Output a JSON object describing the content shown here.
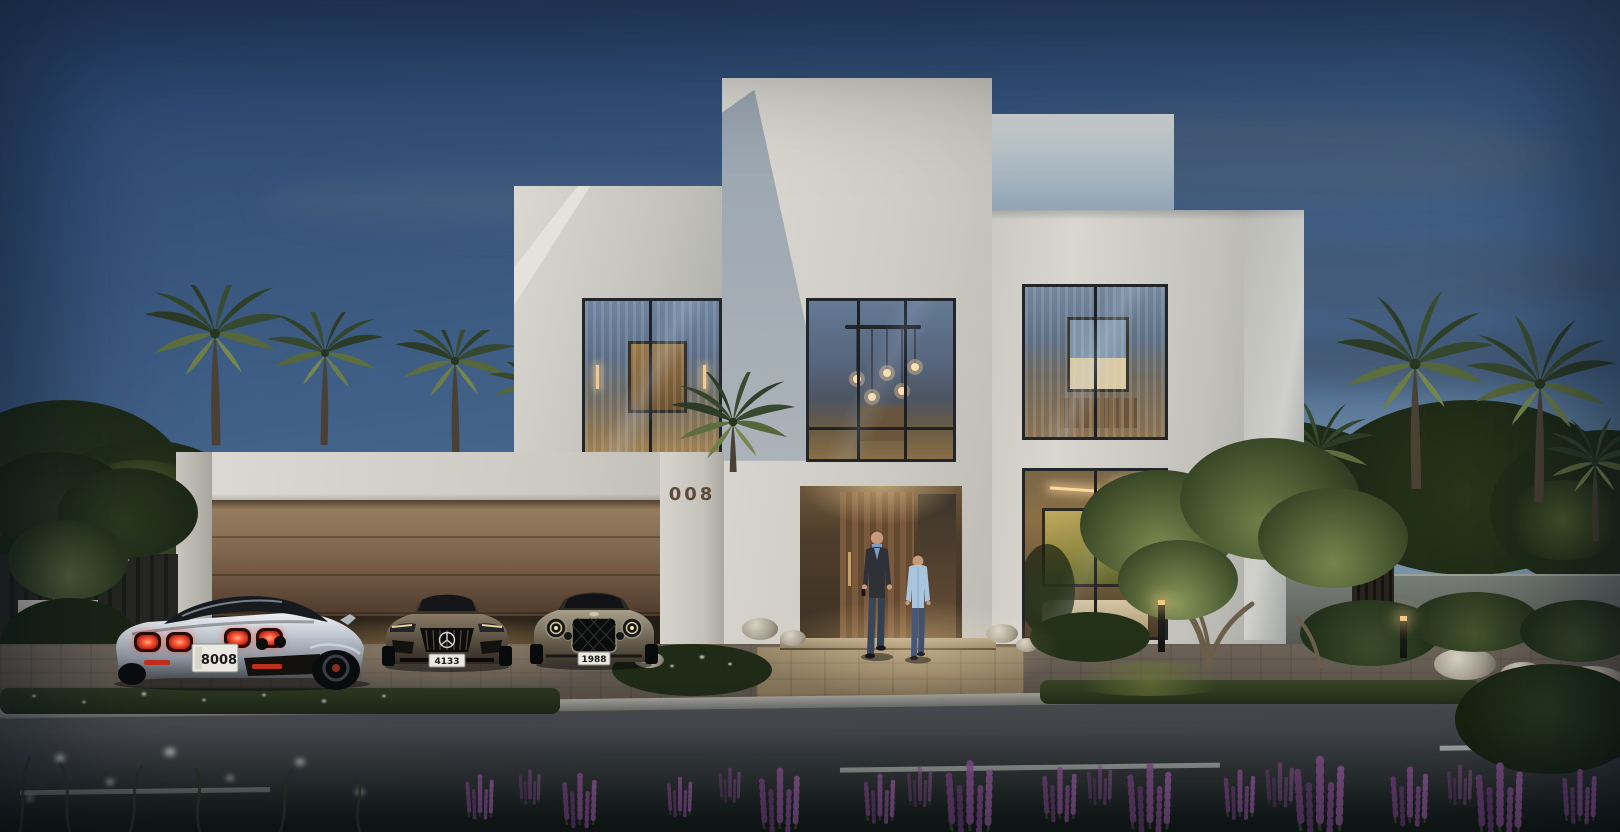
{
  "scene": {
    "title": "Modern luxury villa at dusk",
    "setting": "two-storey white villa with lit interiors, three-car garage, palm trees, front street"
  },
  "house": {
    "number": "008"
  },
  "vehicles": [
    {
      "name": "silver supercar on driveway",
      "plate": "8008"
    },
    {
      "name": "dark grey sports coupe in garage",
      "plate": "4133"
    },
    {
      "name": "grey luxury car in garage",
      "plate": "1988"
    }
  ],
  "people": [
    {
      "name": "man in dark suit"
    },
    {
      "name": "boy in light blue shirt"
    }
  ],
  "palette": {
    "sky_top": "#2b4672",
    "sky_mid": "#47688f",
    "sky_low": "#7e99ab",
    "cloud": "#4e6076",
    "facade": "#d8d6cf",
    "facade_shade": "#99a3ad",
    "canopy": "#d6d4cd",
    "bronze_light": "#8d7356",
    "bronze_dark": "#463827",
    "glass_sky": "#5a7290",
    "glass_warm": "#8a6e48",
    "warm_light": "#e8b974",
    "door_wood": "#6e5138",
    "pavement": "#675e54",
    "road": "#3e4044",
    "lane_mark": "#d9dcd8",
    "foliage": "#22301d",
    "foliage_lit": "#75854a",
    "flower_purple": "#8f5494",
    "plate_bg": "#eae8e1",
    "taillight": "#ff5a3c",
    "car_silver": "#c3c9d1"
  }
}
